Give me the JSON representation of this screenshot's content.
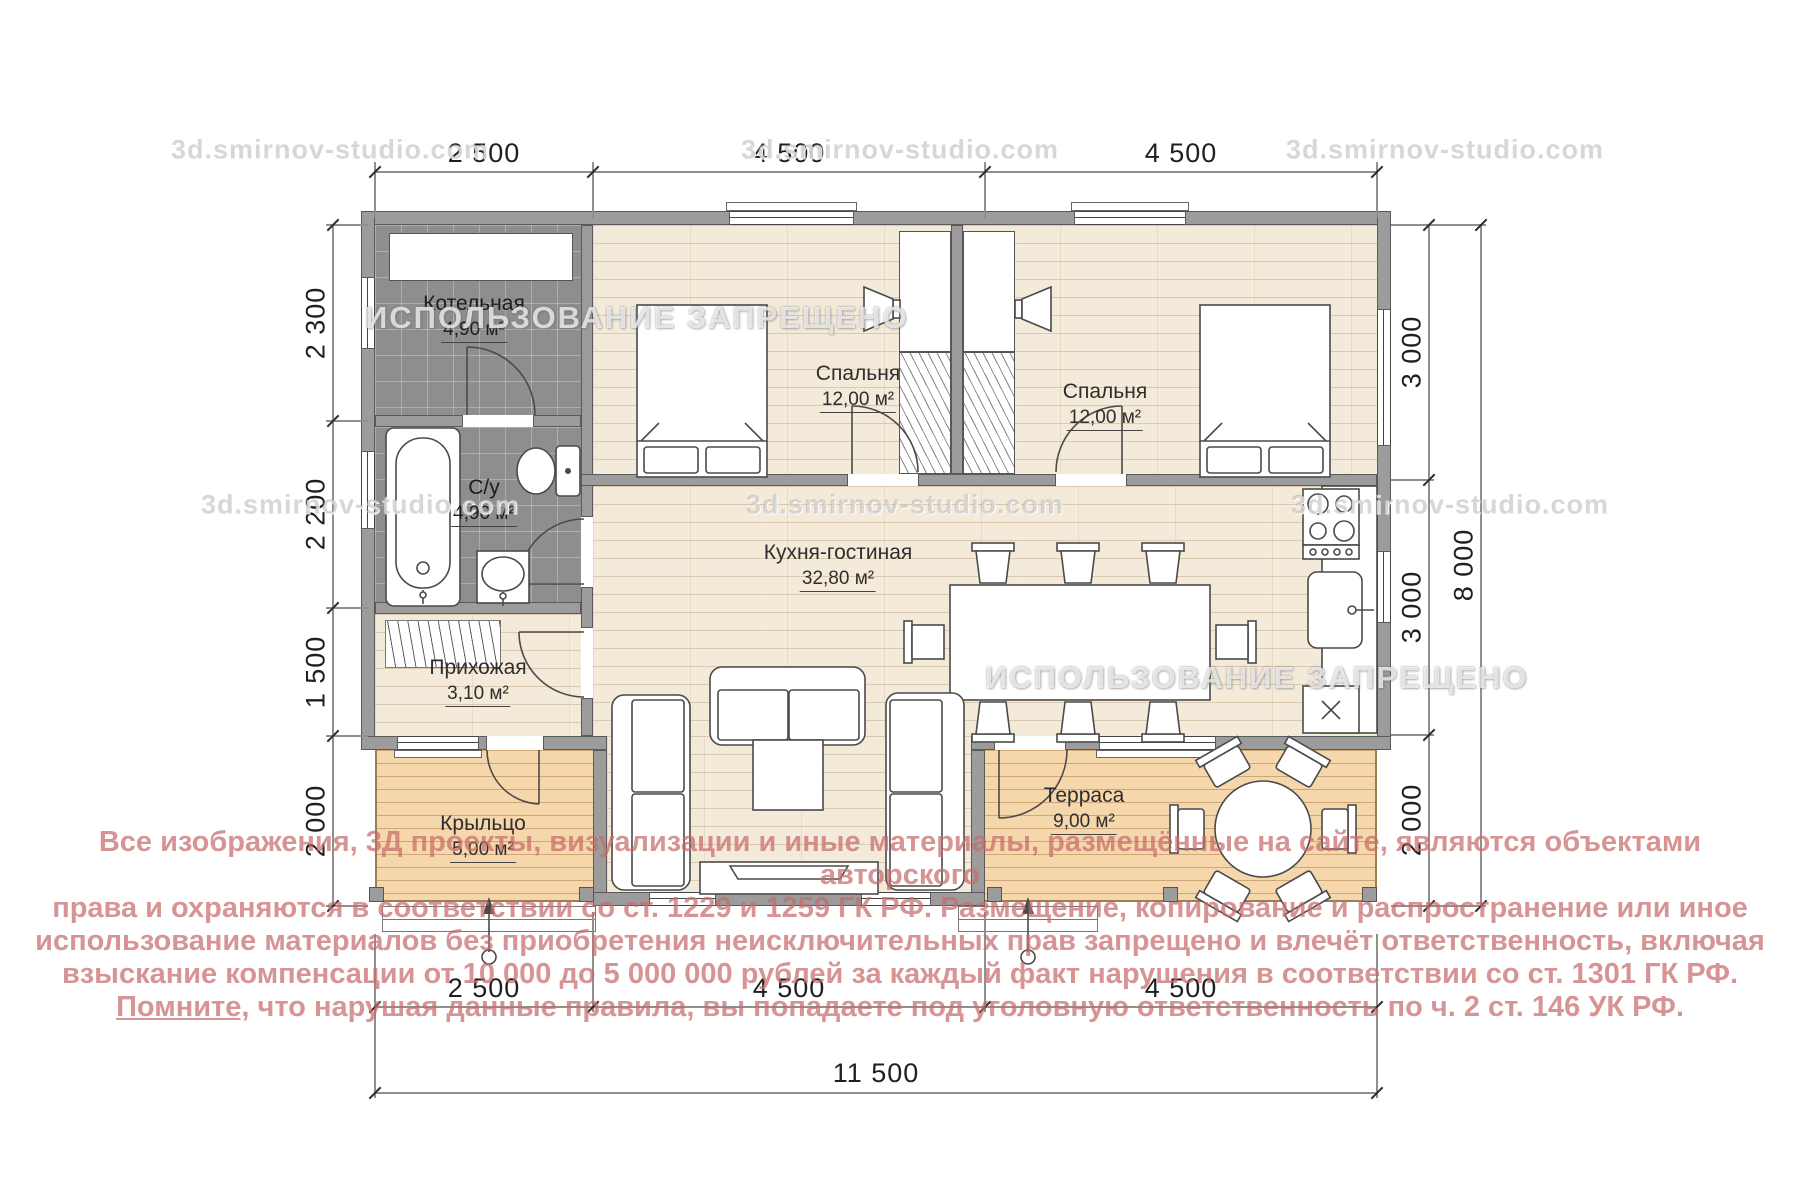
{
  "watermarks": {
    "studio": "3d.smirnov-studio.com",
    "forbidden": "ИСПОЛЬЗОВАНИЕ ЗАПРЕЩЕНО"
  },
  "rooms": {
    "boiler": {
      "name": "Котельная",
      "area": "4,90 м²"
    },
    "bathroom": {
      "name": "С/у",
      "area": "4,90 м²"
    },
    "hallway": {
      "name": "Прихожая",
      "area": "3,10 м²"
    },
    "kitchen_living": {
      "name": "Кухня-гостиная",
      "area": "32,80 м²"
    },
    "bedroom1": {
      "name": "Спальня",
      "area": "12,00 м²"
    },
    "bedroom2": {
      "name": "Спальня",
      "area": "12,00 м²"
    },
    "porch": {
      "name": "Крыльцо",
      "area": "5,00 м²"
    },
    "terrace": {
      "name": "Терраса",
      "area": "9,00 м²"
    }
  },
  "dimensions": {
    "top": [
      "2 500",
      "4 500",
      "4 500"
    ],
    "bottom": [
      "2 500",
      "4 500",
      "4 500"
    ],
    "bottom_total": "11 500",
    "left": [
      "2 300",
      "2 200",
      "1 500",
      "2 000"
    ],
    "right": [
      "3 000",
      "3 000",
      "2 000"
    ],
    "right_total": "8 000"
  },
  "copyright": {
    "line1": "Все изображения, 3Д проекты, визуализации и иные материалы, размещённые на сайте, являются объектами авторского",
    "line2": "права и охраняются в соответствии со ст. 1229 и 1259 ГК РФ. Размещение, копирование и распространение или иное",
    "line3": "использование материалов без приобретения неисключительных прав запрещено и влечёт ответственность, включая",
    "line4": "взыскание компенсации от 10 000 до 5 000 000 рублей за каждый факт нарушения в соответствии со ст. 1301 ГК РФ.",
    "line5_underlined": "Помните,",
    "line5_rest": " что нарушая данные правила, вы попадаете под уголовную ответственность по ч. 2 ст. 146 УК РФ."
  },
  "colors": {
    "copyright_pink": "#c66b6b",
    "wall_gray": "#9c9c9c",
    "tile_gray": "#8e8e8e",
    "wood_floor": "#f3ead9",
    "deck_wood": "#f6d7ac"
  }
}
